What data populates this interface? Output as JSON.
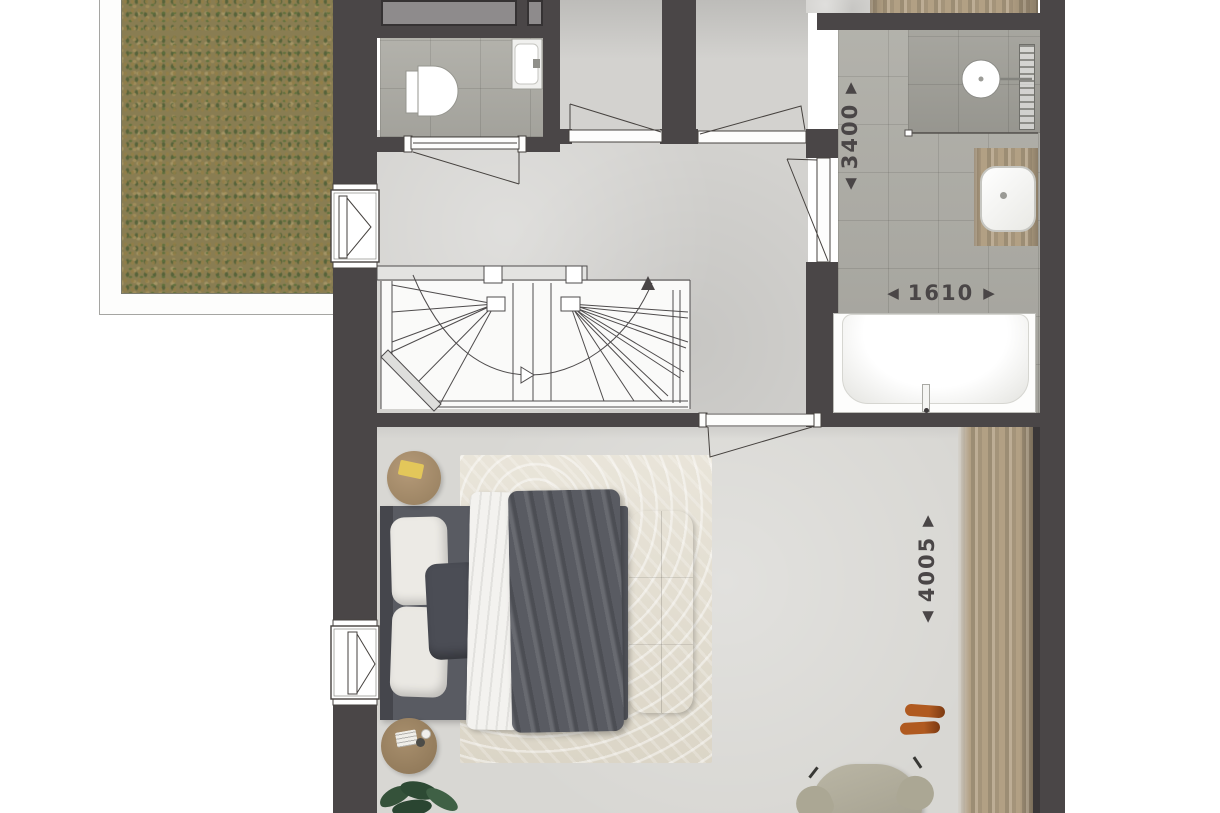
{
  "dimensions": {
    "bath_depth": {
      "start_arrow": "◀",
      "value": "3400",
      "end_arrow": "▶"
    },
    "bath_width": {
      "start_arrow": "◀",
      "value": "1610",
      "end_arrow": "▶"
    },
    "bedroom_depth": {
      "start_arrow": "◀",
      "value": "4005",
      "end_arrow": "▶"
    }
  },
  "colors": {
    "wall": "#4a4647",
    "hall_floor": "#d3d2cf",
    "bedroom_floor": "#d8d7d3",
    "tile_floor": "#adaca5",
    "shower_floor": "#a09f98",
    "wood": "#b2a084",
    "rug": "#e2dccd",
    "roof_base": "#897d52",
    "dimension_text": "#4a4647",
    "duvet": "#595b62",
    "bench": "#c6beac",
    "accent_shoes": "#b05a20"
  }
}
